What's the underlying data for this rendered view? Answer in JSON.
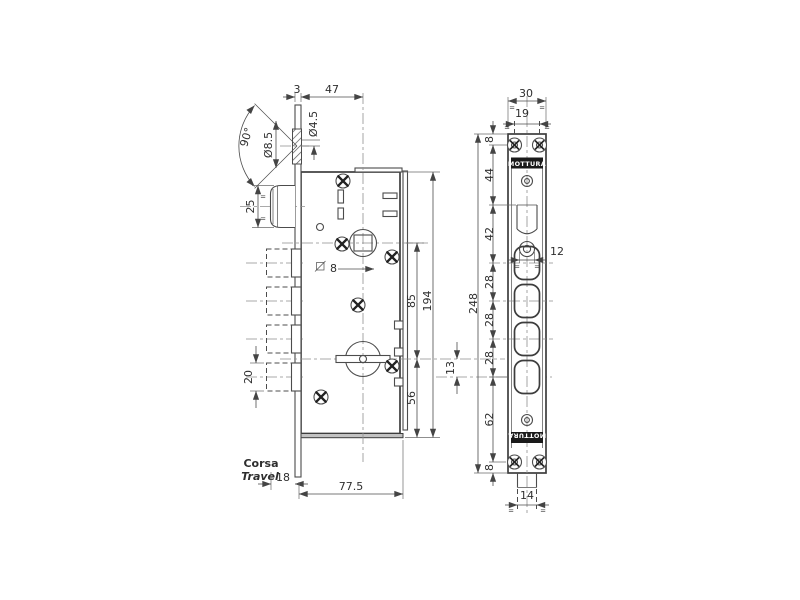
{
  "brand": "MOTTURA",
  "eq": "=",
  "main_view": {
    "dim_plate_thickness": "3",
    "dim_backset": "47",
    "angle_countersink": "90°",
    "dia_countersink": "Ø8.5",
    "dia_hole": "Ø4.5",
    "dim_latch_height": "25",
    "dim_bolt_height": "20",
    "square_spindle": "8",
    "dim_spindle_to_cylinder": "85",
    "dim_body_height": "194",
    "dim_cylinder_to_bottom": "56",
    "dim_cylinder_to_bolt": "13",
    "travel_label_it": "Corsa",
    "travel_label_en": "Travel",
    "dim_travel": "18",
    "dim_body_width": "77.5"
  },
  "side_view": {
    "dim_width": "30",
    "dim_screw_spacing": "19",
    "dim_hole": "12",
    "dim_bottom_width": "14",
    "dim_total_height": "248",
    "chain": [
      "8",
      "44",
      "42",
      "28",
      "28",
      "28",
      "62",
      "8"
    ]
  }
}
